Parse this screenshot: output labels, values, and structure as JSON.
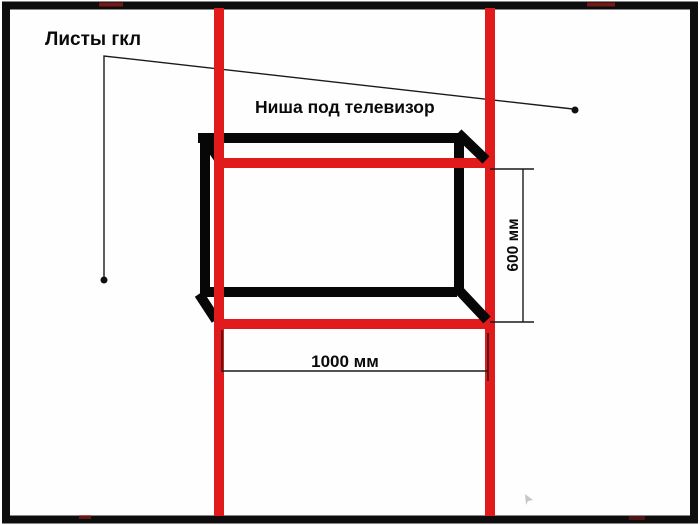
{
  "diagram": {
    "type": "construction-sketch",
    "title_note": "hand-drawn drywall TV niche framing scheme",
    "colors": {
      "background": "#fefefe",
      "frame": "#0d0d0d",
      "niche_outline": "#070707",
      "profile_red": "#e11b1b",
      "dimension_line": "#1a1a1a",
      "cursor_gray": "#b9b9b9"
    },
    "labels": {
      "drywall_callout": "Листы гкл",
      "niche_title": "Ниша под телевизор",
      "width_dimension": "1000 мм",
      "height_dimension": "600 мм"
    },
    "dimensions": {
      "niche_width_mm": 1000,
      "niche_height_mm": 600
    }
  }
}
